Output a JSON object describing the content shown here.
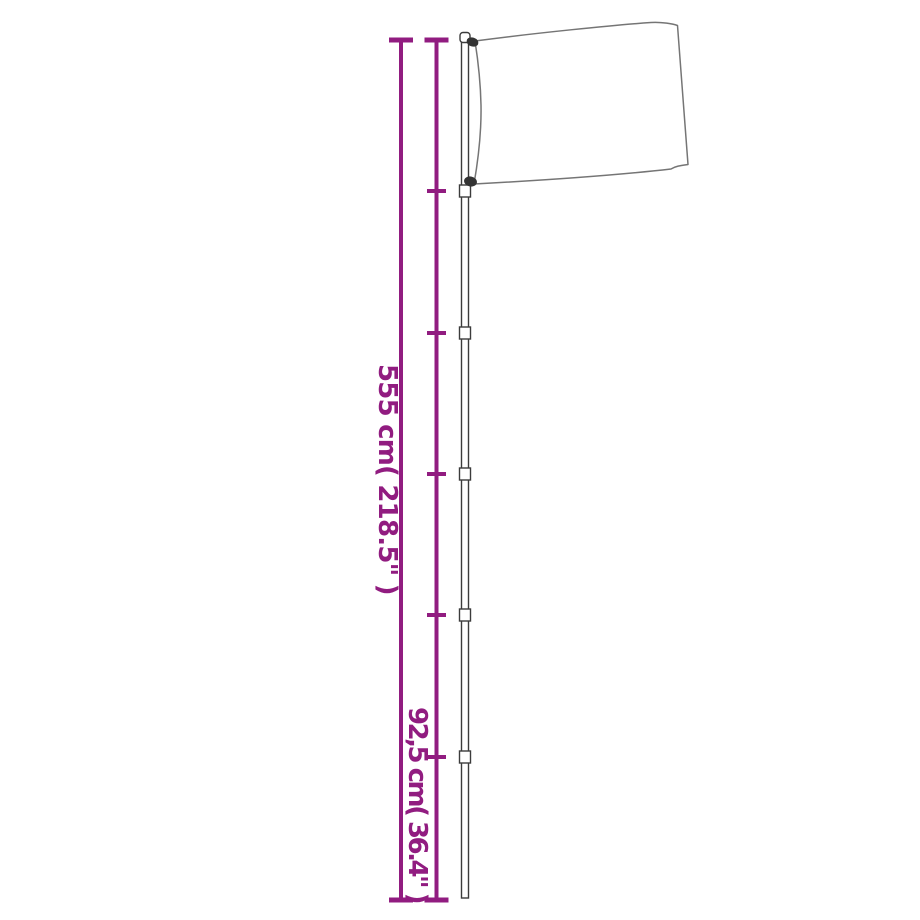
{
  "diagram": {
    "background": "#ffffff",
    "accent_color": "#911c80",
    "pole_outline_color": "#3c3c3c",
    "flag_outline_color": "#757575",
    "clip_color": "#333333",
    "labels": {
      "total_height": "555 cm( 218.5\" )",
      "section_height": "92,5 cm( 36.4\" )"
    },
    "measurements": {
      "total_height_cm": "555",
      "total_height_inch": "218.5",
      "section_height_cm": "92,5",
      "section_height_inch": "36.4"
    },
    "pole_sections": 6
  }
}
